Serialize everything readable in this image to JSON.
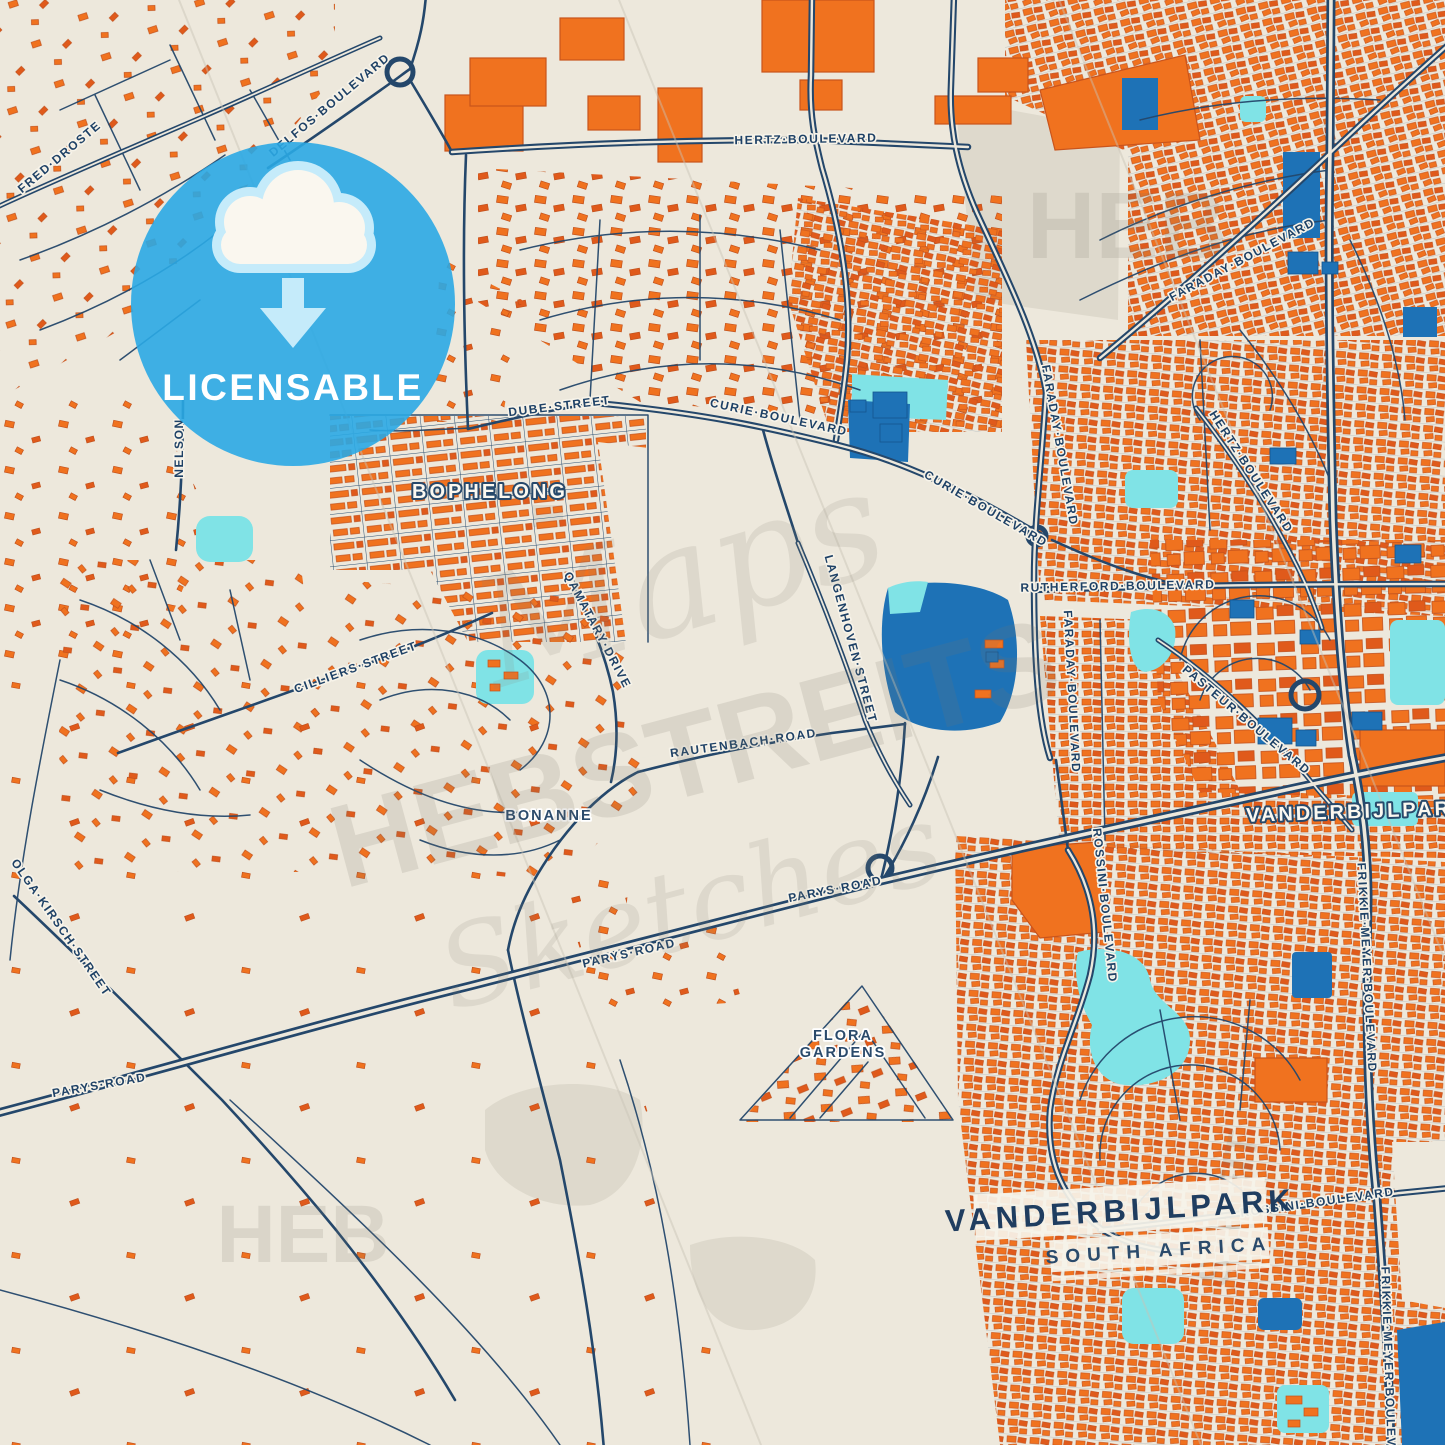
{
  "badge": {
    "label": "LICENSABLE",
    "icon": "cloud-download-icon"
  },
  "title_card": {
    "city": "VANDERBIJLPARK",
    "country": "SOUTH AFRICA"
  },
  "area_labels": [
    {
      "text": "BOPHELONG",
      "x": 490,
      "y": 498,
      "rot": 0,
      "style": "district"
    },
    {
      "text": "VANDERBIJLPARK",
      "x": 1358,
      "y": 818,
      "rot": -2,
      "style": "district"
    },
    {
      "text": "BONANNE",
      "x": 549,
      "y": 820,
      "rot": 0,
      "style": "hood"
    },
    {
      "text": "FLORA",
      "x": 843,
      "y": 1040,
      "rot": 0,
      "style": "hood"
    },
    {
      "text": "GARDENS",
      "x": 843,
      "y": 1057,
      "rot": 0,
      "style": "hood"
    }
  ],
  "street_labels": [
    {
      "text": "DELFOS·BOULEVARD",
      "x": 332,
      "y": 108,
      "rot": -40
    },
    {
      "text": "FRED·DROSTE",
      "x": 62,
      "y": 160,
      "rot": -40
    },
    {
      "text": "NELSON",
      "x": 183,
      "y": 448,
      "rot": -90
    },
    {
      "text": "HERTZ·BOULEVARD",
      "x": 806,
      "y": 143,
      "rot": -1
    },
    {
      "text": "DUBE·STREET",
      "x": 560,
      "y": 410,
      "rot": -7
    },
    {
      "text": "CURIE·BOULEVARD",
      "x": 778,
      "y": 421,
      "rot": 12
    },
    {
      "text": "CURIE·BOULEVARD",
      "x": 984,
      "y": 512,
      "rot": 30
    },
    {
      "text": "CILLIERS·STREET",
      "x": 357,
      "y": 671,
      "rot": -20
    },
    {
      "text": "QAMATARY·DRIVE",
      "x": 594,
      "y": 632,
      "rot": 62
    },
    {
      "text": "RAUTENBACH·ROAD",
      "x": 744,
      "y": 747,
      "rot": -8
    },
    {
      "text": "LANGENHOVEN·STREET",
      "x": 847,
      "y": 640,
      "rot": 75
    },
    {
      "text": "PARYS·ROAD",
      "x": 836,
      "y": 893,
      "rot": -11
    },
    {
      "text": "PARYS·ROAD",
      "x": 630,
      "y": 957,
      "rot": -13
    },
    {
      "text": "PARYS·ROAD",
      "x": 100,
      "y": 1089,
      "rot": -10
    },
    {
      "text": "OLGA·KIRSCH·STREET",
      "x": 58,
      "y": 930,
      "rot": 55
    },
    {
      "text": "RUTHERFORD·BOULEVARD",
      "x": 1118,
      "y": 590,
      "rot": -1
    },
    {
      "text": "FARADAY·BOULEVARD",
      "x": 1244,
      "y": 263,
      "rot": -28
    },
    {
      "text": "FARADAY·BOULEVARD",
      "x": 1056,
      "y": 446,
      "rot": 80
    },
    {
      "text": "FARADAY·BOULEVARD",
      "x": 1068,
      "y": 692,
      "rot": 87
    },
    {
      "text": "HERTZ·BOULEVARD",
      "x": 1248,
      "y": 474,
      "rot": 57
    },
    {
      "text": "PASTEUR·BOULEVARD",
      "x": 1244,
      "y": 723,
      "rot": 40
    },
    {
      "text": "ROSSINI·BOULEVARD",
      "x": 1101,
      "y": 906,
      "rot": 84
    },
    {
      "text": "ROSSINI·BOULEVARD",
      "x": 1318,
      "y": 1206,
      "rot": -8
    },
    {
      "text": "FRIKKIE·MEYER·BOULEVARD",
      "x": 1363,
      "y": 968,
      "rot": 87
    },
    {
      "text": "FRIKKIE·MEYER·BOULEVARD",
      "x": 1385,
      "y": 1372,
      "rot": 88
    }
  ],
  "watermarks": [
    {
      "text": "HEB",
      "x": 1127,
      "y": 258,
      "size": 95,
      "rot": 0,
      "style": "block"
    },
    {
      "text": "HEB",
      "x": 303,
      "y": 1262,
      "size": 82,
      "rot": 0,
      "style": "block"
    },
    {
      "text": "STREIT",
      "x": 1243,
      "y": 1212,
      "size": 44,
      "rot": -78,
      "style": "block"
    },
    {
      "text": "Maps",
      "x": 695,
      "y": 628,
      "size": 150,
      "rot": -17,
      "style": "script"
    },
    {
      "text": "HEBSTREITS",
      "x": 705,
      "y": 792,
      "size": 118,
      "rot": -15,
      "style": "block"
    },
    {
      "text": "Sketches",
      "x": 700,
      "y": 944,
      "size": 112,
      "rot": -15,
      "style": "script"
    }
  ],
  "colors": {
    "background": "#EDE8DC",
    "road": "#24476B",
    "road_minor": "#2E5173",
    "building": "#F0721F",
    "building_edge": "#C2511C",
    "water_blue": "#1E72B6",
    "water_cyan": "#80E3E6",
    "gray_zone": "#DED9CC",
    "label": "#1E4166",
    "label_halo": "#F7F3E9",
    "badge_blue": "#2AA9E4",
    "badge_light": "#C5EBFA",
    "title_navy": "#1F3D60"
  }
}
